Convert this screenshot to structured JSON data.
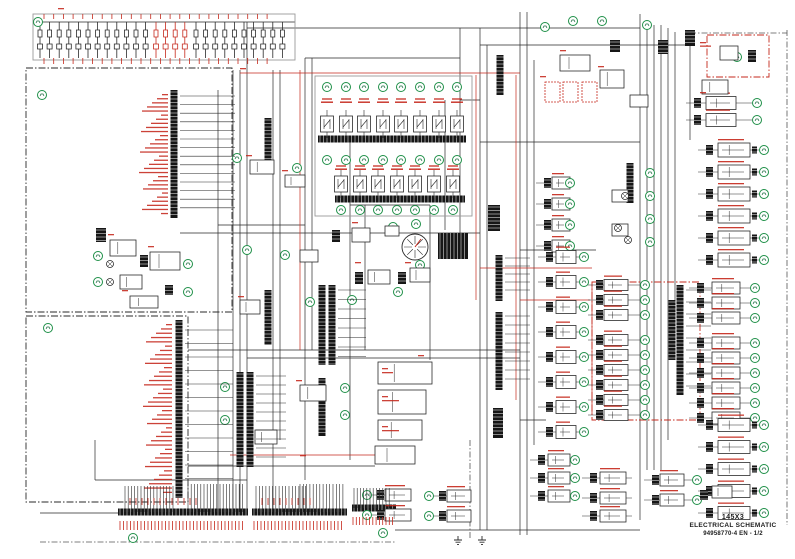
{
  "title_block": {
    "model": "145X3",
    "title": "ELECTRICAL SCHEMATIC",
    "doc_ref": "94958770-4 EN - 1/2"
  },
  "colors": {
    "wire_black": "#2a2a2a",
    "label_red": "#c5281c",
    "ref_green": "#1f9048",
    "dark_fill": "#161616",
    "enclosure_gray": "#9a9a9a",
    "paper": "#ffffff"
  },
  "icons": {
    "reference-circle-icon": "green circled component designator",
    "fuse-icon": "inline fuse symbol",
    "relay-icon": "relay module with contacts",
    "terminal-strip-icon": "multi-pin terminal strip",
    "connector-icon": "black connector block",
    "lamp-icon": "indicator lamp circle",
    "gauge-icon": "circular gauge dial",
    "ground-icon": "chassis ground symbol"
  },
  "schematic": {
    "canvas": {
      "w": 795,
      "h": 559
    },
    "enclosures": [
      {
        "x": 26,
        "y": 68,
        "w": 206,
        "h": 244,
        "s": "dd",
        "c": "k"
      },
      {
        "x": 26,
        "y": 316,
        "w": 162,
        "h": 186,
        "s": "dd",
        "c": "k"
      },
      {
        "x": 592,
        "y": 282,
        "w": 108,
        "h": 138,
        "s": "dd",
        "c": "r"
      },
      {
        "x": 707,
        "y": 35,
        "w": 62,
        "h": 42,
        "s": "dd",
        "c": "r"
      },
      {
        "x": 315,
        "y": 76,
        "w": 157,
        "h": 140,
        "s": "s",
        "c": "g"
      },
      {
        "x": 33,
        "y": 14,
        "w": 262,
        "h": 46,
        "s": "s",
        "c": "g"
      }
    ],
    "dash_lines": [
      [
        40,
        542,
        395,
        542
      ],
      [
        470,
        440,
        470,
        540
      ],
      [
        787,
        30,
        787,
        525
      ],
      [
        690,
        33,
        787,
        33
      ]
    ],
    "wires_black": [
      [
        233,
        70,
        233,
        512
      ],
      [
        240,
        70,
        240,
        512
      ],
      [
        247,
        22,
        247,
        512
      ],
      [
        273,
        70,
        273,
        512
      ],
      [
        280,
        70,
        280,
        440
      ],
      [
        305,
        58,
        305,
        480
      ],
      [
        312,
        58,
        312,
        350
      ],
      [
        350,
        140,
        350,
        460
      ],
      [
        365,
        205,
        365,
        350
      ],
      [
        430,
        205,
        430,
        360
      ],
      [
        445,
        100,
        445,
        230
      ],
      [
        460,
        28,
        460,
        250
      ],
      [
        480,
        28,
        480,
        530
      ],
      [
        487,
        45,
        487,
        530
      ],
      [
        520,
        12,
        520,
        535
      ],
      [
        527,
        12,
        527,
        535
      ],
      [
        534,
        60,
        534,
        445
      ],
      [
        640,
        14,
        640,
        520
      ],
      [
        647,
        25,
        647,
        470
      ],
      [
        654,
        25,
        654,
        470
      ],
      [
        661,
        25,
        661,
        470
      ],
      [
        668,
        28,
        668,
        440
      ],
      [
        675,
        32,
        675,
        300
      ],
      [
        690,
        35,
        690,
        140
      ],
      [
        218,
        90,
        218,
        512
      ],
      [
        95,
        440,
        95,
        480
      ],
      [
        38,
        22,
        295,
        22
      ],
      [
        247,
        28,
        640,
        28
      ],
      [
        480,
        45,
        690,
        45
      ],
      [
        305,
        58,
        460,
        58
      ],
      [
        218,
        225,
        305,
        225
      ],
      [
        180,
        233,
        480,
        233
      ],
      [
        188,
        350,
        520,
        350
      ],
      [
        247,
        358,
        520,
        358
      ],
      [
        95,
        480,
        247,
        480
      ],
      [
        395,
        530,
        640,
        530
      ],
      [
        480,
        142,
        640,
        142
      ],
      [
        520,
        250,
        596,
        250
      ],
      [
        520,
        420,
        546,
        420
      ],
      [
        188,
        466,
        375,
        466
      ],
      [
        350,
        205,
        430,
        205
      ],
      [
        350,
        140,
        460,
        140
      ],
      [
        460,
        100,
        480,
        100
      ],
      [
        40,
        513,
        118,
        513
      ]
    ],
    "wires_red": [
      [
        300,
        70,
        300,
        350
      ],
      [
        476,
        75,
        476,
        300
      ],
      [
        516,
        75,
        516,
        400
      ],
      [
        592,
        285,
        592,
        415
      ],
      [
        240,
        73,
        520,
        73
      ],
      [
        480,
        268,
        592,
        268
      ],
      [
        230,
        455,
        375,
        455
      ],
      [
        520,
        300,
        590,
        300
      ]
    ],
    "fuse_rows": [
      {
        "x": 40,
        "y": 30,
        "n": 12,
        "pitch": 9.6,
        "c": "k"
      },
      {
        "x": 156,
        "y": 30,
        "n": 4,
        "pitch": 9.6,
        "c": "r"
      },
      {
        "x": 196,
        "y": 30,
        "n": 10,
        "pitch": 9.6,
        "c": "k"
      }
    ],
    "vstrips": [
      [
        174,
        90,
        128
      ],
      [
        179,
        320,
        178
      ],
      [
        268,
        118,
        48
      ],
      [
        268,
        290,
        55
      ],
      [
        240,
        372,
        95
      ],
      [
        250,
        372,
        95
      ],
      [
        322,
        285,
        80
      ],
      [
        332,
        285,
        80
      ],
      [
        322,
        378,
        58
      ],
      [
        499,
        255,
        46
      ],
      [
        499,
        312,
        78
      ],
      [
        500,
        55,
        40
      ],
      [
        680,
        285,
        110
      ],
      [
        672,
        300,
        60
      ],
      [
        630,
        163,
        40
      ]
    ],
    "hstrips": [
      [
        118,
        512,
        130
      ],
      [
        252,
        512,
        95
      ],
      [
        352,
        508,
        44
      ],
      [
        318,
        139,
        148
      ],
      [
        335,
        199,
        130
      ]
    ],
    "relay_banks": [
      {
        "xs": [
          327,
          346,
          364,
          383,
          401,
          420,
          439,
          457
        ],
        "relay_y": 116,
        "ca": 87,
        "cb": 160,
        "label_y": 99
      },
      {
        "xs": [
          341,
          360,
          378,
          397,
          415,
          434,
          453
        ],
        "relay_y": 176,
        "cb": 210,
        "label_y": 166
      }
    ],
    "rows": [
      {
        "cx": 706,
        "bx": 718,
        "bw": 32,
        "bh": 14,
        "gx": 764,
        "ec": 752,
        "ys": [
          150,
          172,
          194,
          216,
          238,
          260
        ]
      },
      {
        "cx": 697,
        "bx": 712,
        "bw": 28,
        "bh": 12,
        "gx": 755,
        "ys": [
          288,
          303,
          318,
          343,
          358,
          373,
          388,
          403,
          418
        ]
      },
      {
        "cx": 706,
        "bx": 718,
        "bw": 32,
        "bh": 13,
        "gx": 764,
        "ec": 752,
        "ys": [
          425,
          447,
          469,
          491,
          513
        ]
      },
      {
        "cx": 596,
        "bx": 604,
        "bw": 24,
        "bh": 11,
        "gx": 645,
        "ys": [
          285,
          300,
          315,
          340,
          355,
          370,
          385,
          400,
          415
        ]
      },
      {
        "cx": 544,
        "bx": 552,
        "bw": 18,
        "bh": 12,
        "gx": 570,
        "ys": [
          183,
          204,
          225,
          246
        ]
      },
      {
        "cx": 546,
        "bx": 556,
        "bw": 20,
        "bh": 13,
        "gx": 584,
        "ys": [
          257,
          282,
          307,
          332,
          357,
          382,
          407,
          432
        ]
      },
      {
        "cx": 538,
        "bx": 548,
        "bw": 22,
        "bh": 12,
        "gx": 575,
        "ys": [
          460,
          478,
          496
        ]
      },
      {
        "cx": 694,
        "bx": 706,
        "bw": 30,
        "bh": 13,
        "gx": 757,
        "ys": [
          103,
          120
        ]
      },
      {
        "cx": 377,
        "bx": 385,
        "bw": 26,
        "bh": 12,
        "gx": 367,
        "ys": [
          495,
          515
        ]
      },
      {
        "cx": 439,
        "bx": 447,
        "bw": 24,
        "bh": 12,
        "gx": 429,
        "ys": [
          496,
          516
        ]
      },
      {
        "cx": 590,
        "bx": 600,
        "bw": 26,
        "bh": 12,
        "gx": 0,
        "ys": [
          478,
          498,
          516
        ]
      },
      {
        "cx": 652,
        "bx": 660,
        "bw": 24,
        "bh": 12,
        "gx": 697,
        "ys": [
          480,
          500
        ]
      }
    ],
    "gcircs": [
      [
        38,
        22
      ],
      [
        545,
        27
      ],
      [
        573,
        21
      ],
      [
        602,
        21
      ],
      [
        647,
        25
      ],
      [
        737,
        57
      ],
      [
        723,
        86
      ],
      [
        42,
        95
      ],
      [
        98,
        256
      ],
      [
        98,
        282
      ],
      [
        188,
        264
      ],
      [
        188,
        292
      ],
      [
        48,
        328
      ],
      [
        133,
        538
      ],
      [
        383,
        533
      ],
      [
        358,
        233
      ],
      [
        393,
        227
      ],
      [
        416,
        224
      ],
      [
        420,
        265
      ],
      [
        398,
        292
      ],
      [
        352,
        300
      ],
      [
        345,
        388
      ],
      [
        345,
        415
      ],
      [
        237,
        158
      ],
      [
        297,
        168
      ],
      [
        247,
        250
      ],
      [
        285,
        255
      ],
      [
        225,
        387
      ],
      [
        225,
        420
      ],
      [
        310,
        302
      ],
      [
        650,
        173
      ],
      [
        650,
        196
      ],
      [
        650,
        219
      ],
      [
        650,
        242
      ]
    ],
    "boxes": [
      [
        110,
        240,
        26,
        16
      ],
      [
        150,
        252,
        30,
        18
      ],
      [
        120,
        275,
        22,
        14
      ],
      [
        130,
        296,
        28,
        12
      ],
      [
        352,
        228,
        18,
        14
      ],
      [
        385,
        226,
        14,
        10
      ],
      [
        368,
        270,
        22,
        14
      ],
      [
        410,
        268,
        20,
        14
      ],
      [
        250,
        160,
        24,
        14
      ],
      [
        285,
        175,
        20,
        12
      ],
      [
        300,
        250,
        18,
        12
      ],
      [
        240,
        300,
        20,
        14
      ],
      [
        300,
        385,
        26,
        16
      ],
      [
        255,
        430,
        22,
        14
      ],
      [
        378,
        362,
        54,
        22
      ],
      [
        378,
        390,
        48,
        24
      ],
      [
        378,
        420,
        44,
        20
      ],
      [
        375,
        446,
        40,
        18
      ],
      [
        560,
        55,
        30,
        16
      ],
      [
        600,
        70,
        24,
        18
      ],
      [
        630,
        95,
        18,
        12
      ],
      [
        545,
        82,
        15,
        20,
        "r"
      ],
      [
        563,
        82,
        15,
        20,
        "r"
      ],
      [
        582,
        82,
        15,
        20,
        "r"
      ],
      [
        720,
        46,
        18,
        14
      ],
      [
        702,
        80,
        26,
        14
      ],
      [
        612,
        190,
        16,
        12
      ],
      [
        612,
        224,
        16,
        12
      ],
      [
        712,
        486,
        20,
        12
      ]
    ],
    "conns": [
      [
        96,
        228,
        10,
        14
      ],
      [
        140,
        255,
        8,
        12
      ],
      [
        165,
        285,
        8,
        10
      ],
      [
        355,
        272,
        8,
        12
      ],
      [
        398,
        272,
        8,
        12
      ],
      [
        332,
        230,
        8,
        12
      ],
      [
        610,
        40,
        10,
        12
      ],
      [
        658,
        40,
        10,
        14
      ],
      [
        685,
        30,
        10,
        16
      ],
      [
        748,
        50,
        8,
        12
      ],
      [
        438,
        233,
        30,
        26
      ],
      [
        488,
        205,
        12,
        26
      ],
      [
        493,
        408,
        10,
        30
      ],
      [
        700,
        490,
        8,
        10
      ]
    ],
    "lamps": [
      [
        110,
        264
      ],
      [
        110,
        282
      ],
      [
        625,
        196
      ],
      [
        618,
        228
      ],
      [
        628,
        240
      ]
    ],
    "gauges": [
      [
        415,
        247,
        13
      ]
    ],
    "grounds": [
      [
        458,
        536
      ],
      [
        482,
        536
      ]
    ],
    "rlabels": [
      [
        168,
        94,
        30,
        4.1,
        24,
        -1
      ],
      [
        172,
        324,
        40,
        4.3,
        24,
        -1
      ],
      [
        382,
        368,
        2,
        4,
        16,
        1
      ],
      [
        382,
        396,
        2,
        4,
        14,
        1
      ],
      [
        382,
        426,
        2,
        4,
        14,
        1
      ],
      [
        352,
        222,
        1,
        3,
        14,
        1
      ],
      [
        355,
        262,
        1,
        3,
        16,
        1
      ],
      [
        405,
        262,
        1,
        3,
        14,
        1
      ],
      [
        108,
        234,
        1,
        3,
        14,
        1
      ],
      [
        148,
        246,
        1,
        3,
        16,
        1
      ],
      [
        122,
        290,
        1,
        3,
        12,
        1
      ],
      [
        540,
        76,
        1,
        3,
        12,
        1
      ],
      [
        560,
        50,
        1,
        3,
        16,
        1
      ],
      [
        598,
        66,
        1,
        3,
        14,
        1
      ],
      [
        700,
        42,
        2,
        3.5,
        16,
        1
      ],
      [
        700,
        92,
        1,
        3,
        14,
        1
      ],
      [
        58,
        8,
        1,
        3,
        45,
        1
      ],
      [
        240,
        68,
        1,
        3,
        30,
        1
      ],
      [
        246,
        155,
        1,
        3,
        14,
        1
      ],
      [
        282,
        170,
        1,
        3,
        12,
        1
      ],
      [
        238,
        296,
        1,
        3,
        12,
        1
      ],
      [
        296,
        380,
        1,
        3,
        16,
        1
      ],
      [
        418,
        355,
        1,
        3,
        20,
        1
      ],
      [
        300,
        455,
        1,
        3,
        16,
        1
      ]
    ],
    "combs": [
      [
        125,
        486,
        16,
        3.2,
        26,
        "k"
      ],
      [
        188,
        484,
        18,
        3.2,
        28,
        "k"
      ],
      [
        256,
        486,
        16,
        3.3,
        26,
        "k"
      ],
      [
        300,
        484,
        14,
        3.3,
        28,
        "k"
      ],
      [
        354,
        488,
        12,
        3.2,
        20,
        "k"
      ],
      [
        120,
        521,
        36,
        3.5,
        9,
        "r"
      ],
      [
        254,
        521,
        26,
        3.5,
        9,
        "r"
      ],
      [
        353,
        517,
        13,
        3.3,
        8,
        "r"
      ],
      [
        130,
        498,
        12,
        6,
        7,
        "r"
      ],
      [
        262,
        498,
        9,
        6,
        7,
        "r"
      ],
      [
        44,
        14,
        24,
        9.7,
        5,
        "r"
      ],
      [
        44,
        58,
        24,
        9.7,
        6,
        "r"
      ]
    ],
    "stubs": [
      [
        180,
        96,
        14,
        8.6,
        55
      ],
      [
        185,
        330,
        12,
        13.5,
        48
      ],
      [
        256,
        376,
        10,
        9,
        30
      ],
      [
        338,
        290,
        8,
        9.5,
        28
      ],
      [
        686,
        290,
        9,
        12,
        25
      ],
      [
        505,
        258,
        5,
        8,
        25
      ],
      [
        505,
        316,
        8,
        9,
        25
      ]
    ]
  }
}
